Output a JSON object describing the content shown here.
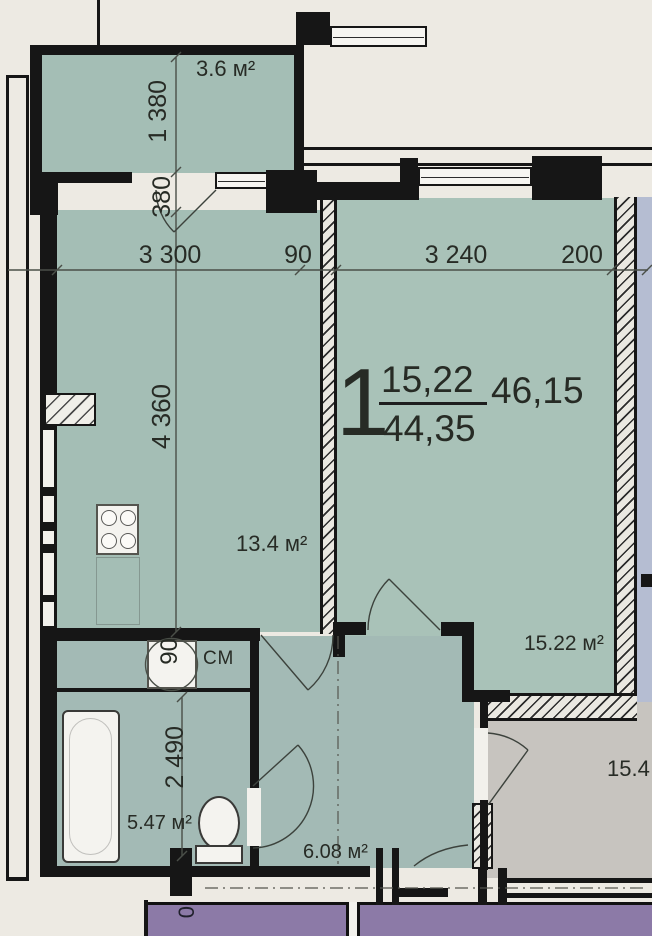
{
  "title": "1-room apartment floor plan",
  "unit_label": {
    "rooms_count": "1",
    "living_area": "15,22",
    "total_area": "44,35",
    "area_with_balcony": "46,15"
  },
  "rooms": {
    "balcony": {
      "area": "3.6 м²"
    },
    "kitchen": {
      "area": "13.4 м²"
    },
    "living_room": {
      "area": "15.22 м²"
    },
    "bathroom": {
      "area": "5.47 м²"
    },
    "hallway": {
      "area": "6.08 м²"
    },
    "adjacent_room": {
      "area": "15.4"
    }
  },
  "dimensions": {
    "balcony_length": "1 380",
    "balcony_door": "380",
    "kitchen_width": "3 300",
    "partition_width": "90",
    "living_width": "3 240",
    "outer_wall": "200",
    "kitchen_depth": "4 360",
    "niche_width": "90",
    "bathroom_depth": "2 490",
    "shaft_partial": "0"
  },
  "labels": {
    "washing_machine": "СМ"
  },
  "colors": {
    "room_fill": "#a4beb5",
    "living_fill": "#a9c2b8",
    "adjacent_fill": "#c7c4bf",
    "neighbor_fill": "#b5bdd2",
    "corridor_band": "#8c7aa7",
    "wall": "#161616",
    "background": "#edeae3"
  }
}
